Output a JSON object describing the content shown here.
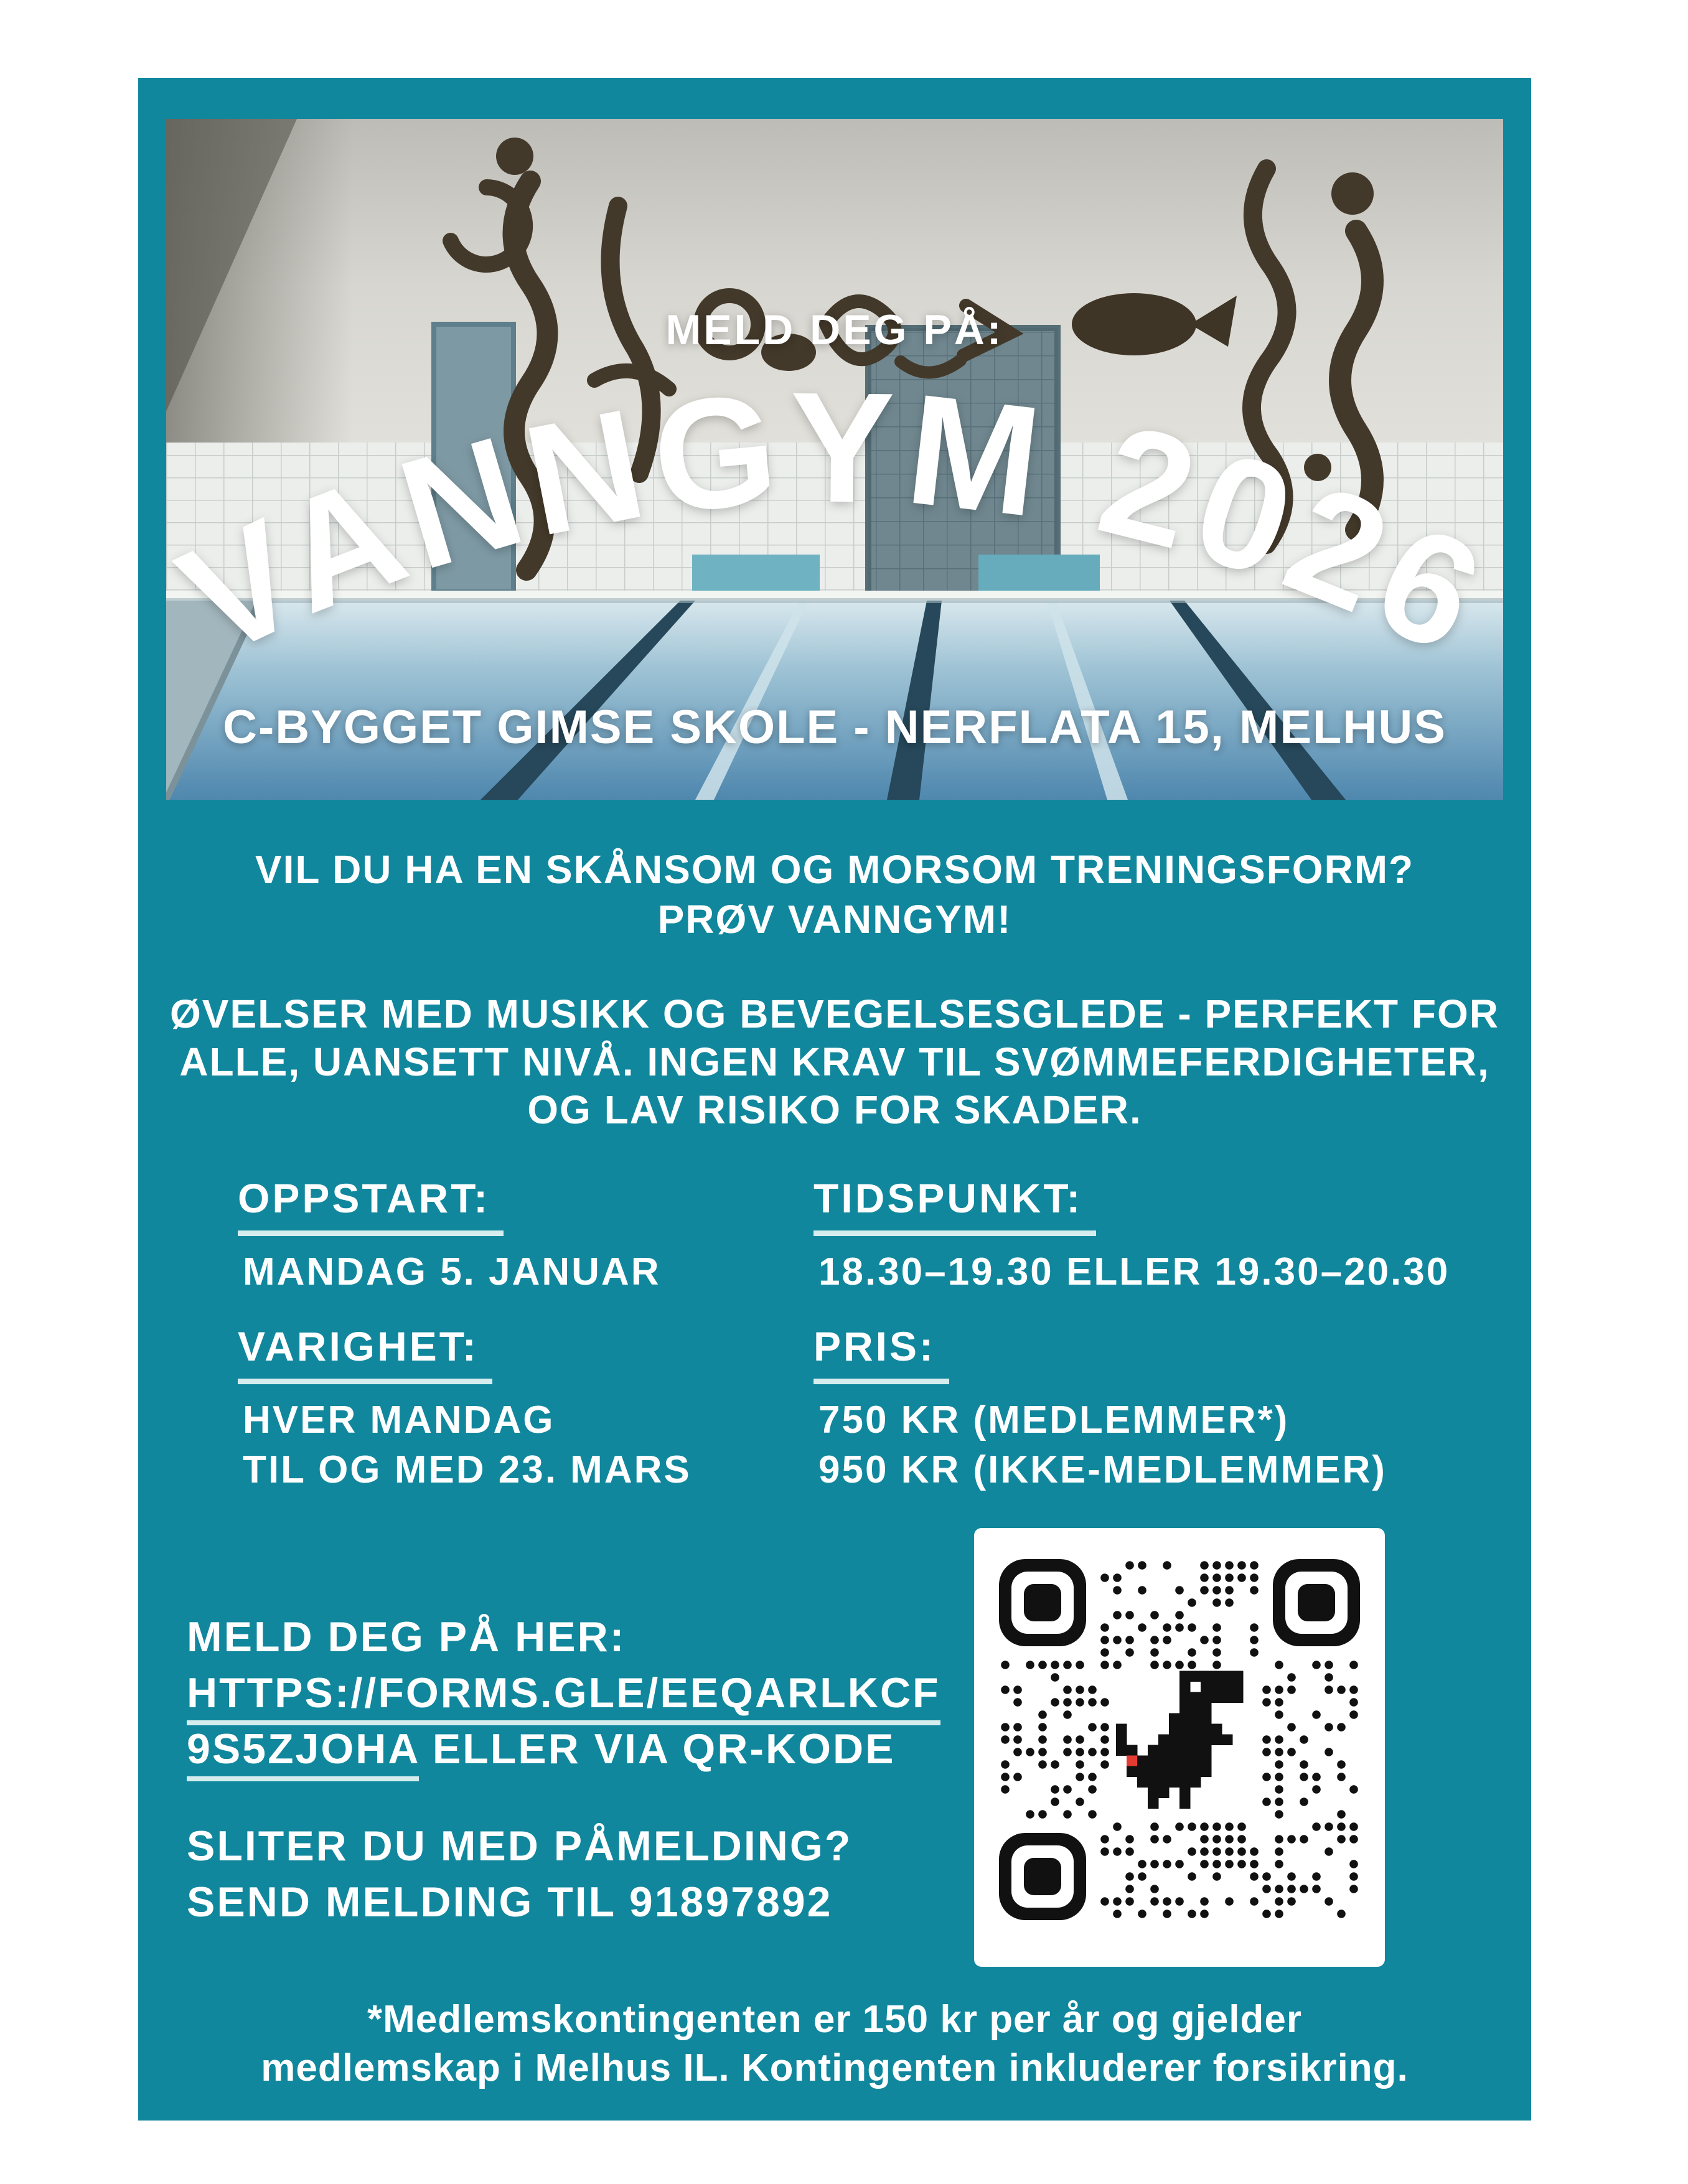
{
  "colors": {
    "page_background": "#FFFFFF",
    "poster_teal": "#10879D",
    "text": "#FFFFFF",
    "underline": "#D6EDEE",
    "qr_background": "#FFFFFF",
    "qr_foreground": "#111111",
    "qr_dino_accent": "#E23B32"
  },
  "photo": {
    "illustration": "indoor-swimming-pool-with-wall-sculptures",
    "kicker": "MELD DEG PÅ:",
    "arch_title": "VANNGYM 2026",
    "address": "C-BYGGET GIMSE SKOLE - NERFLATA 15, MELHUS"
  },
  "intro": {
    "headline": "VIL DU HA EN SKÅNSOM OG MORSOM TRENINGSFORM?\nPRØV VANNGYM!",
    "paragraph": "ØVELSER MED MUSIKK OG BEVEGELSESGLEDE - PERFEKT FOR\nALLE, UANSETT NIVÅ. INGEN KRAV TIL SVØMMEFERDIGHETER,\nOG LAV RISIKO FOR SKADER."
  },
  "details": {
    "oppstart": {
      "label": "OPPSTART:",
      "value": "MANDAG 5. JANUAR"
    },
    "tidspunkt": {
      "label": "TIDSPUNKT:",
      "value": "18.30–19.30 ELLER 19.30–20.30"
    },
    "varighet": {
      "label": "VARIGHET:",
      "value": "HVER MANDAG\nTIL OG MED 23. MARS"
    },
    "pris": {
      "label": "PRIS:",
      "value": "750 KR (MEDLEMMER*)\n950 KR (IKKE-MEDLEMMER)"
    }
  },
  "signup": {
    "heading": "MELD DEG PÅ HER:",
    "url_line1": "HTTPS://FORMS.GLE/EEQARLKCF",
    "url_line2_link": "9S5ZJOHA",
    "url_line2_rest": " ELLER VIA QR-KODE",
    "help": "SLITER DU MED PÅMELDING?\nSEND MELDING TIL 91897892"
  },
  "qr": {
    "icon": "qr-code-dino-icon"
  },
  "footer": "*Medlemskontingenten er 150 kr per år og gjelder\nmedlemskap i Melhus IL. Kontingenten inkluderer forsikring."
}
